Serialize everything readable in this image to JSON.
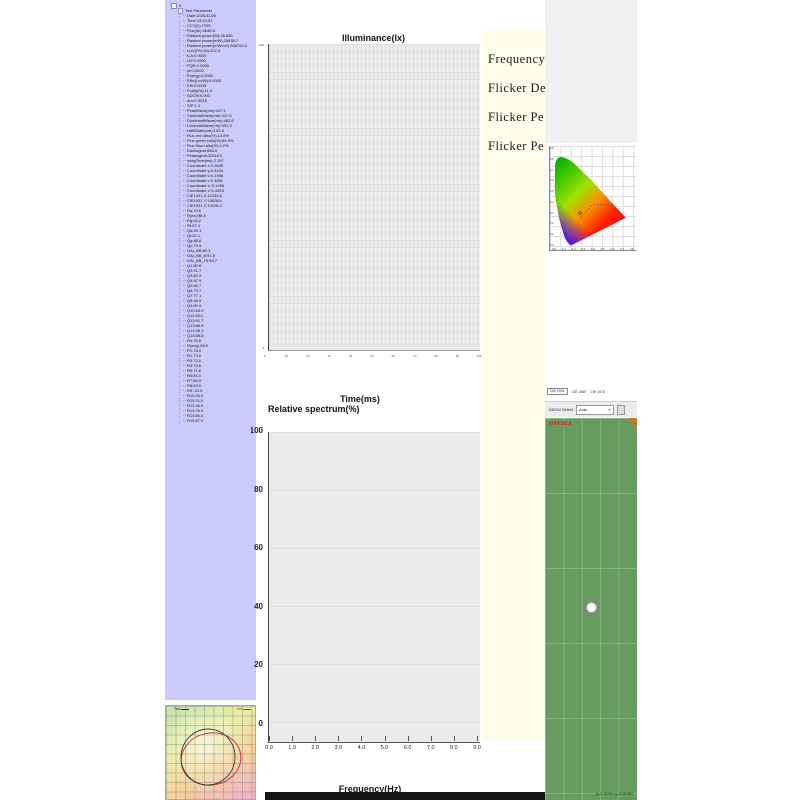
{
  "colors": {
    "sidebar_bg": "#CBCBFB",
    "chart_bg": "#EBEBEB",
    "cream_bg": "#FDFDE9",
    "panel_bg": "#F0F0F0",
    "green_bg": "#689B60",
    "max_red": "#E02020",
    "bottom_bar": "#151515"
  },
  "tree": {
    "root_label": "0",
    "title": "Test Parameter",
    "items": [
      "Date:2025/11/20",
      "Time:13:20:51",
      "CCT(K):7295",
      "Flux(lm):4648.8",
      "Radiant power(W):26.836",
      "Radiant power(mW):26835.7",
      "Radiant power(mW/m2):806753.0",
      "LUX(FM-30):322.3",
      "ILA:0.0000",
      "UV:0.0000",
      "PQR:0.0000",
      "pf:0.0000",
      "Energy:0.0000",
      "Effic(Lm/W):0.0000",
      "Effi:0.0000",
      "Purity(%):11.9",
      "SDCM:5.000",
      "duv:0.0015",
      "S/P:1.1",
      "PeakWave(nm):447.3",
      "CentroidWave(nm):447.5",
      "DominantWave(nm):482.6",
      "CentroidWave(nm):531.3",
      "HalfWidth(nm):123.8",
      "Flux red ratio(%):13.8%",
      "Flux green ratio(%):84.9%",
      "Flux blue ratio(%):4.2%",
      "Darksignal:658.0",
      "Peaksignal:32518.0",
      "IntegTime(ms):2.197",
      "Coordinate x:0.2635",
      "Coordinate y:0.3154",
      "Coordinate u:0.1956",
      "Coordinate v:0.3061",
      "Coordinate u':0.1958",
      "Coordinate v':0.4593",
      "CIE1931 X:12153.6",
      "CIE1931 Y:13628.6",
      "CIE1931 Z:13228.4",
      "Ra:79.6",
      "R(es):98.5",
      "Rg:94.2",
      "Rf:57.4",
      "Qa:59.1",
      "Qf:67.1",
      "Qg:88.6",
      "Qp:73.9",
      "GAI_BB:89.3",
      "GAI_BB_8:91.8",
      "GAI_BB_15:93.7",
      "Q1:80.6",
      "Q2:91.7",
      "Q3:62.9",
      "Q4:57.9",
      "Q5:60.7",
      "Q6:73.7",
      "Q7:77.1",
      "Q8:98.5",
      "Q9:80.9",
      "Q10:65.9",
      "Q11:59.1",
      "Q12:91.7",
      "Q13:66.5",
      "Q14:98.3",
      "Q15:69.8",
      "Ra:78.6",
      "R(avg):98.5",
      "R1:78.0",
      "R2:73.0",
      "R3:73.0",
      "R4:73.6",
      "R5:71.6",
      "R6:64.0",
      "R7:80.0",
      "R8:63.0",
      "R9:-23.0",
      "R10:34.0",
      "R11:76.0",
      "R12:46.0",
      "R13:76.0",
      "R14:84.0",
      "R15:67.0"
    ]
  },
  "illuminance_chart": {
    "title": "Illuminance(lx)",
    "x_label": "Time(ms)",
    "y_top_tick": "100",
    "y_bottom_tick": "0",
    "x_ticks": [
      "0",
      "10",
      "20",
      "30",
      "40",
      "50",
      "60",
      "70",
      "80",
      "90",
      "100"
    ]
  },
  "spectrum_chart": {
    "title": "Relative spectrum(%)",
    "x_label": "Frequency(Hz)",
    "y_ticks": [
      "100",
      "80",
      "60",
      "40",
      "20",
      "0"
    ],
    "x_ticks": [
      "0.0",
      "1.0",
      "2.0",
      "3.0",
      "4.0",
      "5.0",
      "6.0",
      "7.0",
      "8.0",
      "9.0"
    ]
  },
  "flicker_panel": {
    "lines": [
      "Frequency(",
      "Flicker De",
      "Flicker Pe",
      "Flicker Pe"
    ]
  },
  "cie_panel": {
    "tabs": [
      "CIE 1931",
      "CIE 1960",
      "CIE 1976"
    ],
    "x_ticks": [
      "0.0",
      "0.1",
      "0.2",
      "0.3",
      "0.4",
      "0.5",
      "0.6",
      "0.7",
      "0.8"
    ],
    "y_ticks": [
      "0.9",
      "0.8",
      "0.7",
      "0.6",
      "0.5",
      "0.4",
      "0.3",
      "0.2",
      "0.1",
      "0.0"
    ]
  },
  "sdcm": {
    "label": "SDCM Select",
    "value": "Auto",
    "chevron": "▼"
  },
  "camera_panel": {
    "max_label": "MAX:92.0",
    "readout": "x:0.0000  y:0.0000"
  },
  "polar_panel": {
    "test_label": "Test",
    "ref_label": "Ref"
  }
}
